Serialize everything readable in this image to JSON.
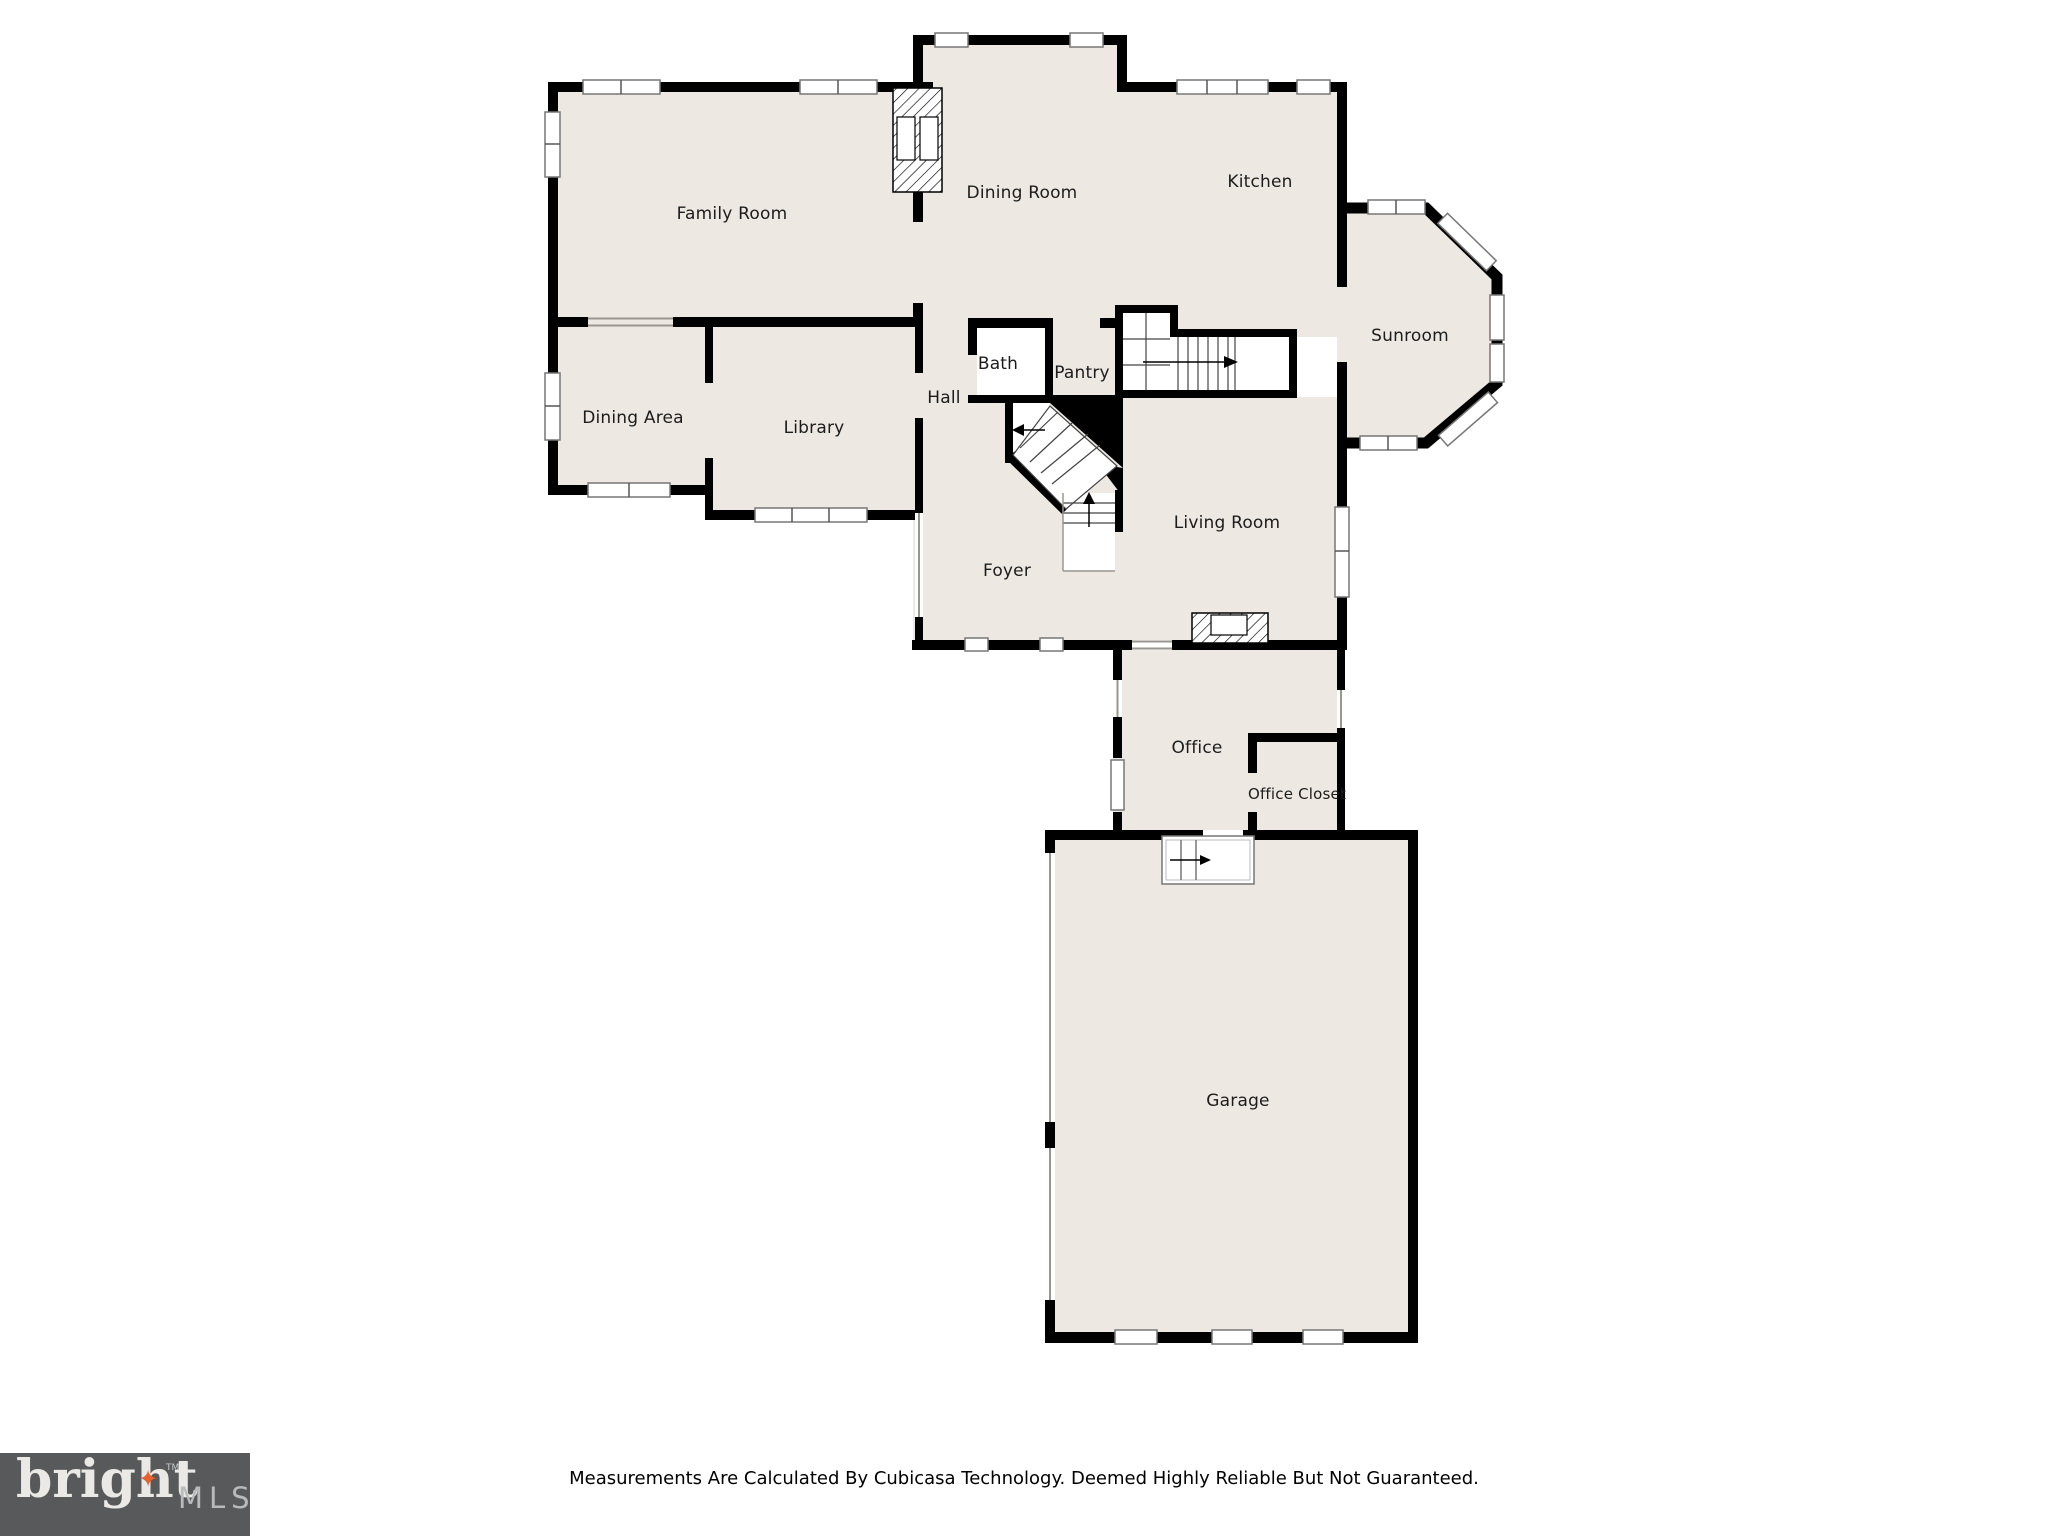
{
  "floor_plan": {
    "rooms": [
      {
        "label": "Family Room"
      },
      {
        "label": "Dining Room"
      },
      {
        "label": "Kitchen"
      },
      {
        "label": "Sunroom"
      },
      {
        "label": "Dining Area"
      },
      {
        "label": "Library"
      },
      {
        "label": "Hall"
      },
      {
        "label": "Bath"
      },
      {
        "label": "Pantry"
      },
      {
        "label": "Living Room"
      },
      {
        "label": "Foyer"
      },
      {
        "label": "Office"
      },
      {
        "label": "Office Closet"
      },
      {
        "label": "Garage"
      }
    ],
    "colors": {
      "room_fill": "#EDE8E1",
      "wall": "#000000",
      "background": "#FFFFFF",
      "window_frame": "#777777"
    }
  },
  "footer": {
    "disclaimer": "Measurements Are Calculated By Cubicasa Technology. Deemed Highly Reliable But Not Guaranteed."
  },
  "logo": {
    "brand": "bright",
    "suffix": "MLS",
    "trademark": "TM",
    "star_glyph": "✦",
    "colors": {
      "box": "#58595B",
      "brand_text": "#EAE9E5",
      "suffix_text": "#B9BABC",
      "star": "#E8622D"
    }
  }
}
